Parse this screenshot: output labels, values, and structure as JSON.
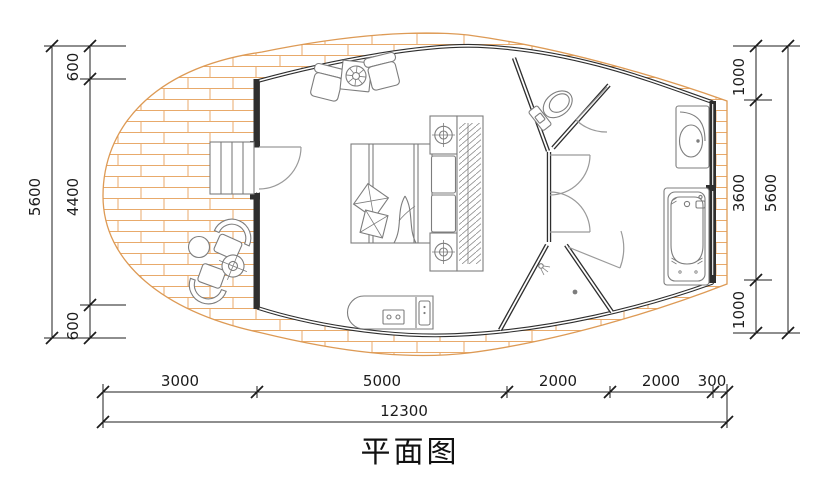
{
  "title": "平面图",
  "colors": {
    "wall": "#2e2e2e",
    "hatch": "#e8aa6b",
    "hatch-edge": "#dd9a55",
    "furn": "#7d7d7d",
    "dim": "#1c1c1c",
    "door": "#9a9a9a"
  },
  "dimensions": {
    "left": {
      "outer": "5600",
      "inner": [
        "600",
        "4400",
        "600"
      ]
    },
    "right": {
      "outer": "5600",
      "inner": [
        "1000",
        "3600",
        "1000"
      ]
    },
    "bottom": {
      "segments": [
        "3000",
        "5000",
        "2000",
        "2000",
        "300"
      ],
      "total": "12300"
    }
  },
  "elements": [
    "wood-deck",
    "entry-stairs",
    "entry-door",
    "lounge-armchairs",
    "fire-table",
    "double-bed",
    "wardrobe",
    "nightstand-lamps",
    "deck-chairs",
    "round-table",
    "side-table",
    "kitchen-counter",
    "toilet",
    "wc-room",
    "shower-room",
    "washbasin",
    "bathtub"
  ]
}
